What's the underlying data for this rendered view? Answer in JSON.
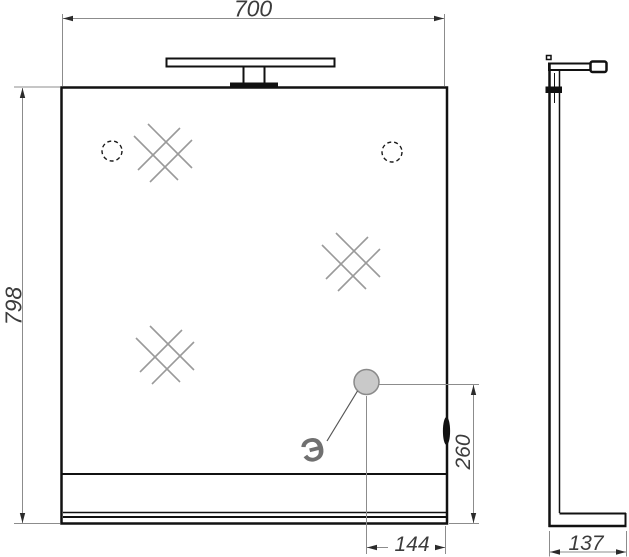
{
  "drawing": {
    "title": "mirror-with-light-technical-drawing",
    "views": [
      "front",
      "side"
    ],
    "dimensions": {
      "front_width": "700",
      "front_height": "798",
      "socket_offset_from_right": "144",
      "socket_height_from_bottom": "260",
      "side_depth": "137"
    },
    "annotations": {
      "electric_point_label": "Э"
    },
    "icons": {
      "glass_hatch": "double-diagonal-cross",
      "mounting_hole": "dashed-circle",
      "electric_point": "filled-gray-circle",
      "side_switch": "black-lens"
    },
    "colors": {
      "object_line": "#111111",
      "dimension_line": "#8c8c8c",
      "dimension_text": "#3c3c3c",
      "hatch": "#9a9a9a",
      "socket_fill": "#c9c9c9",
      "electric_mark": "#707070",
      "background": "#ffffff"
    }
  }
}
